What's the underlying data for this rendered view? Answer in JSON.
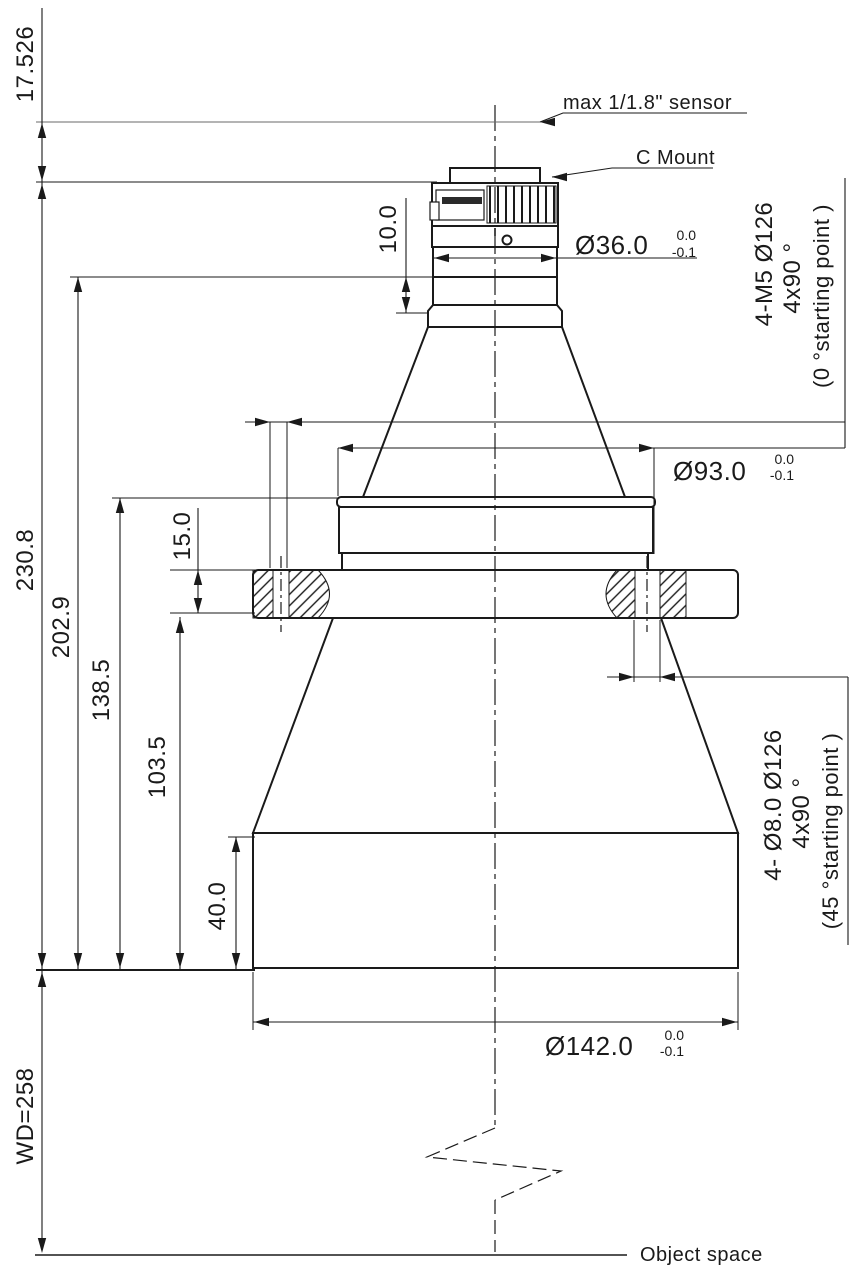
{
  "drawing": {
    "labels": {
      "sensor": "max 1/1.8\" sensor",
      "c_mount": "C Mount",
      "object_space": "Object space",
      "working_distance": "WD=258"
    },
    "dimensions": {
      "flange_focal": "17.526",
      "total_length": "230.8",
      "length_202_9": "202.9",
      "length_138_5": "138.5",
      "length_103_5": "103.5",
      "flange_thickness": "15.0",
      "barrel_height": "40.0",
      "cmount_section": "10.0",
      "dia_36": {
        "value": "Ø36.0",
        "tol_upper": "0.0",
        "tol_lower": "-0.1"
      },
      "dia_93": {
        "value": "Ø93.0",
        "tol_upper": "0.0",
        "tol_lower": "-0.1"
      },
      "dia_142": {
        "value": "Ø142.0",
        "tol_upper": "0.0",
        "tol_lower": "-0.1"
      }
    },
    "notes": {
      "m5_holes": {
        "line1": "4-M5  Ø126",
        "line2": "4x90 °",
        "line3": "(0 °starting point )"
      },
      "dia8_holes": {
        "line1": "4- Ø8.0  Ø126",
        "line2": "4x90 °",
        "line3": "(45 °starting point )"
      }
    }
  }
}
